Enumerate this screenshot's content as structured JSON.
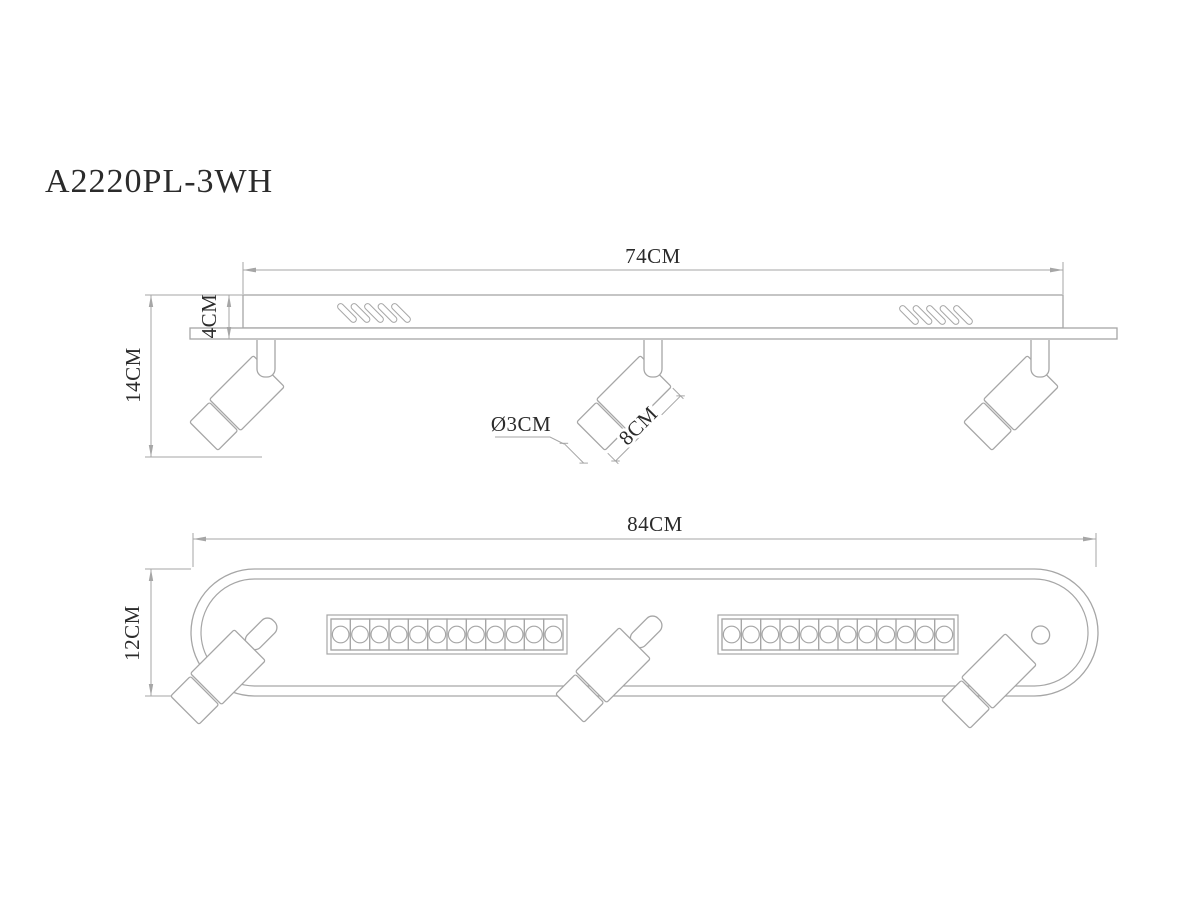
{
  "title": "A2220PL-3WH",
  "colors": {
    "background": "#ffffff",
    "line": "#a6a6a6",
    "text": "#2b2b2b"
  },
  "side_view": {
    "dimensions": {
      "bar_length": "74CM",
      "fixture_height": "4CM",
      "total_height": "14CM",
      "head_diameter": "Ø3CM",
      "head_length": "8CM"
    },
    "spotlight_count": 3,
    "vent_group_count": 2,
    "vent_slots_per_group": 5
  },
  "bottom_view": {
    "dimensions": {
      "base_length": "84CM",
      "base_width": "12CM"
    },
    "spotlight_count": 3,
    "led_strip_count": 2,
    "led_cells_per_strip": 12
  }
}
